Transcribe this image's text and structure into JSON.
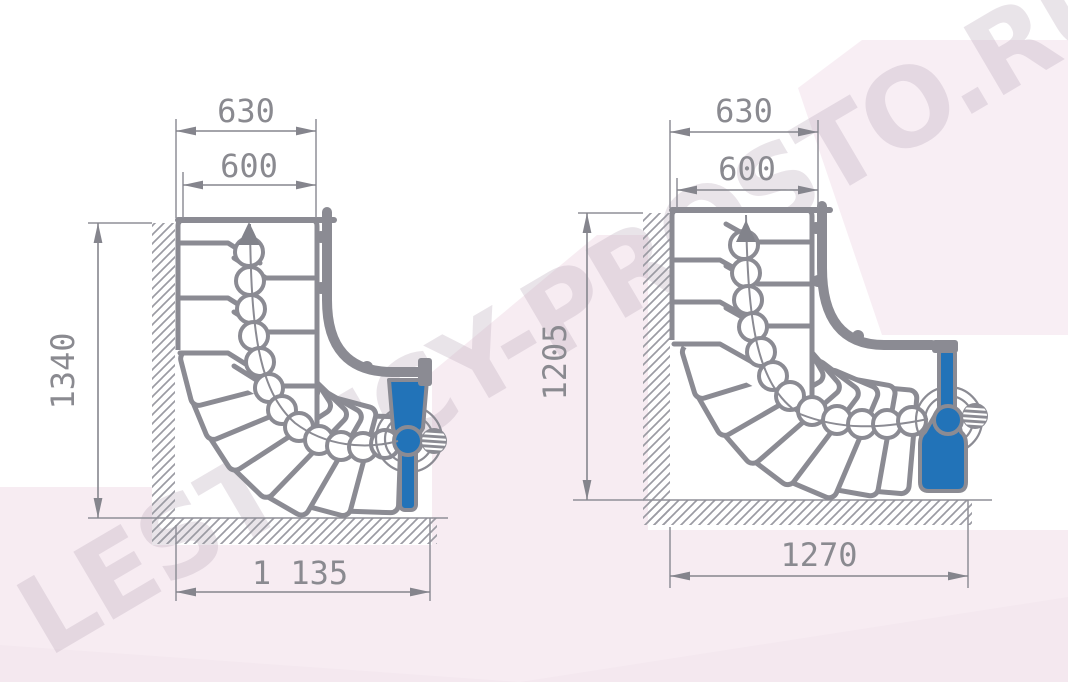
{
  "watermark": {
    "text": "LESTNICY-PROSTO.RU"
  },
  "colors": {
    "drawing_gray": "#8b8b93",
    "dimension_gray": "#8a8a90",
    "accent_blue": "#2273b8",
    "background_pink": "#f7ecf2",
    "background_pink_deep": "#f4e8ef",
    "background_pink_light": "#f8eef4",
    "hatch_gray": "#9b9ba3"
  },
  "left_diagram": {
    "width_top": "630",
    "width_inner": "600",
    "height_left": "1340",
    "width_bottom": "1 135"
  },
  "right_diagram": {
    "width_top": "630",
    "width_inner": "600",
    "height_left": "1205",
    "width_bottom": "1270"
  }
}
